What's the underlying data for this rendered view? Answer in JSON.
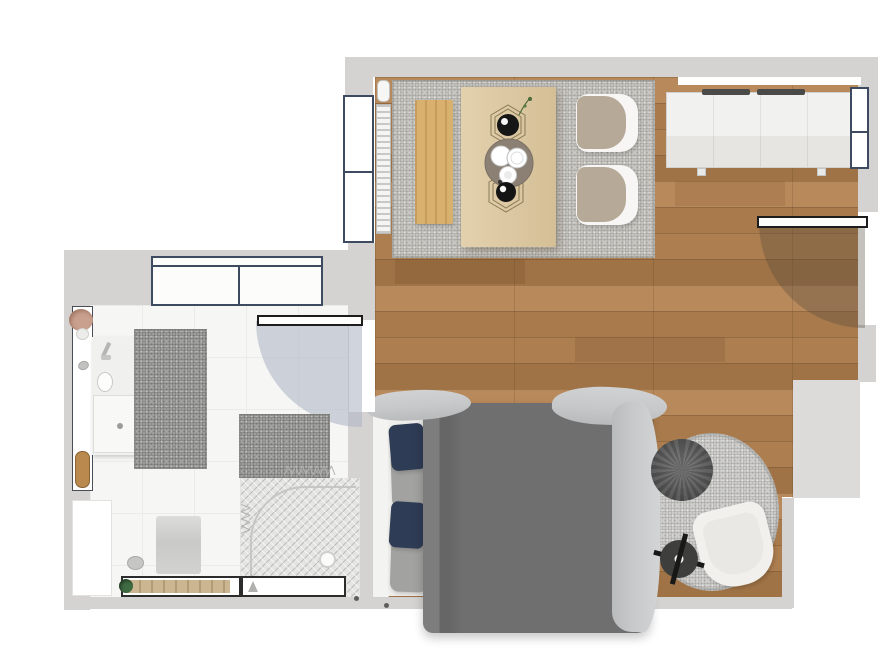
{
  "palette": {
    "wall": "#d4d3d1",
    "wall_light": "#dcdbd9",
    "wood": "#ad7e50",
    "wood_dark": "#9f7346",
    "wood_mid": "#a87a4c",
    "wood_light": "#b8895b",
    "tile": "#f6f6f5",
    "tile_line": "#ebebe9",
    "rug_living": "#c5c3be",
    "rug_bath": "#9d9d9b",
    "rug_round": "#cbcbc9",
    "bench": "#d9b16e",
    "table": "#ddc79c",
    "chair_seat": "#b6a997",
    "shell_white": "#f7f6f4",
    "duvet": "#6f6f6f",
    "sheet": "#efefed",
    "throw": "#c6c8c9",
    "pillow_navy": "#2f3c55",
    "pillow_gray": "#a2a2a0",
    "frame": "#3d4a5f",
    "door_border": "#1c1c1c",
    "swing_bath": "rgba(176,184,198,0.6)",
    "swing_entry": "rgba(86,74,60,0.34)",
    "cabinet": "#f1f1ef",
    "marble": "#e7e5e1",
    "handle": "#4a4a48",
    "pouf": "#565656",
    "side_table": "#3e3e3c",
    "armchair": "#f2f0ec",
    "cushion": "#eae8e4",
    "shower": "#e4e4e2",
    "shower_line": "#c6c6c4",
    "vanity": "#f0f0ee",
    "tray_tan": "#b9894d",
    "plant_pink": "#c9a08e",
    "plant_green": "#3f6b42",
    "towel": "#d2d2d0",
    "zig": "#b0b0ae"
  },
  "icons": {
    "towel_zigzag": "⋀⋀⋀⋀⋀⋀⋀",
    "towel_zigzag_short": "⋀⋀⋀⋀"
  },
  "rooms": [
    {
      "id": "living-bedroom",
      "floor": "wood planks",
      "furniture": [
        "dining area rug",
        "wooden bench",
        "dining table with tray, plates and wire baskets",
        "dining chair",
        "dining chair",
        "radiator",
        "sideboard with marble top",
        "left wall window",
        "right wall window",
        "transom window",
        "entry door",
        "double bed with gray duvet and navy pillows",
        "round rug",
        "knitted pouf",
        "armchair",
        "round side table"
      ]
    },
    {
      "id": "bathroom",
      "floor": "white tile",
      "furniture": [
        "built-in wardrobe",
        "vanity with washbasin",
        "large bath rug",
        "small bath rug",
        "walk-in shower",
        "hanging towels",
        "wall shelf with plant, stone and wooden tray",
        "corner storage cabinet",
        "window bench with plant",
        "bottom window",
        "bathroom door",
        "wall towel",
        "pebble decor"
      ]
    }
  ]
}
